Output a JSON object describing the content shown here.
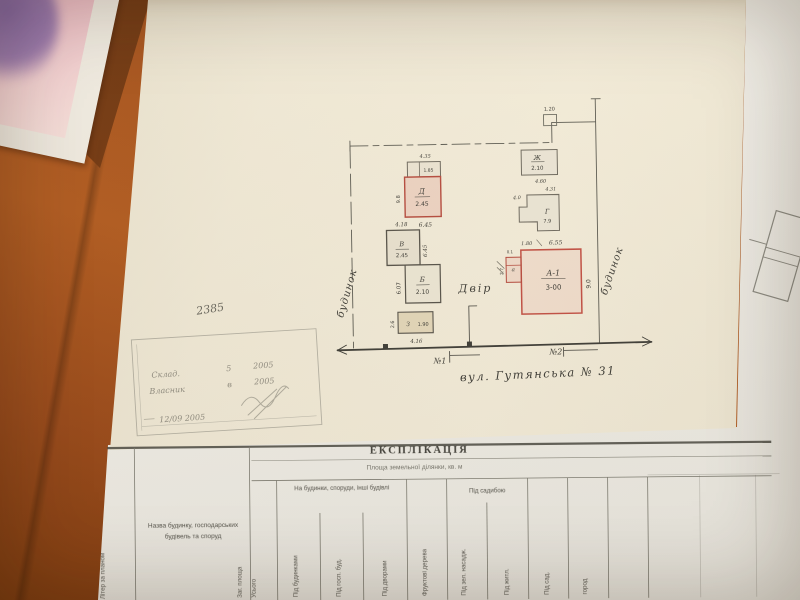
{
  "colors": {
    "desk_wood": "#a3531d",
    "plan_paper": "#efe9d6",
    "table_paper": "#f0efe8",
    "red_outline": "#b44a3e",
    "red_fill": "#e8afa6"
  },
  "plan": {
    "note_number": "2385",
    "left_boundary_label": "будинок",
    "right_boundary_label": "будинок",
    "courtyard_label": "Двір",
    "street_label": "вул. Гутянська № 31",
    "gate_1": "№1",
    "gate_2": "№2",
    "top_dim": "1.20",
    "buildings": {
      "shed": {
        "value": "1.85",
        "dim_top": "4.35"
      },
      "d": {
        "letter": "Д",
        "value": "2.45",
        "dim_left": "9.8",
        "dim_bottom": "6.45"
      },
      "zh": {
        "letter": "Ж",
        "value": "2.10",
        "dim_bottom": "4.60"
      },
      "g": {
        "letter": "Г",
        "value": "7.9",
        "dim_top": "4.31",
        "dim_left": "4.0"
      },
      "v": {
        "letter": "В",
        "value": "2.45",
        "dim_top": "4.18",
        "dim_right": "6.45"
      },
      "b": {
        "letter": "Б",
        "value": "2.10",
        "dim_left": "6.07"
      },
      "z": {
        "letter": "З",
        "value": "1.90",
        "dim_bottom": "4.16",
        "dim_left": "2.6"
      },
      "a1": {
        "letter": "А-1",
        "value": "3-00",
        "dim_top": "6.55",
        "dim_top_left": "1.80",
        "dim_right": "9.0",
        "porch_letter": "а",
        "porch_dim_left": "2.7",
        "porch_dim_top": "0.1"
      }
    }
  },
  "stamp": {
    "line1": "Склад.",
    "line1_num": "5",
    "line1_year": "2005",
    "line2": "Власник",
    "line2_num": "в",
    "line2_year": "2005",
    "date": "12/09 2005"
  },
  "table": {
    "title": "ЕКСПЛІКАЦІЯ",
    "subtitle": "Площа земельної ділянки, кв. м",
    "col_letter": "Літер за планом",
    "col_name": "Назва будинку, господарських будівель та споруд",
    "group_buildings": "На будинки, споруди, інші будівлі",
    "group_yard": "Під садибою",
    "columns": [
      "Заг. площа",
      "Усього",
      "Під будинками",
      "Під госп. буд.",
      "Під дворами",
      "Фруктові дерева",
      "Під зел. насадж.",
      "Під житл.",
      "Під сад.",
      "город"
    ]
  }
}
